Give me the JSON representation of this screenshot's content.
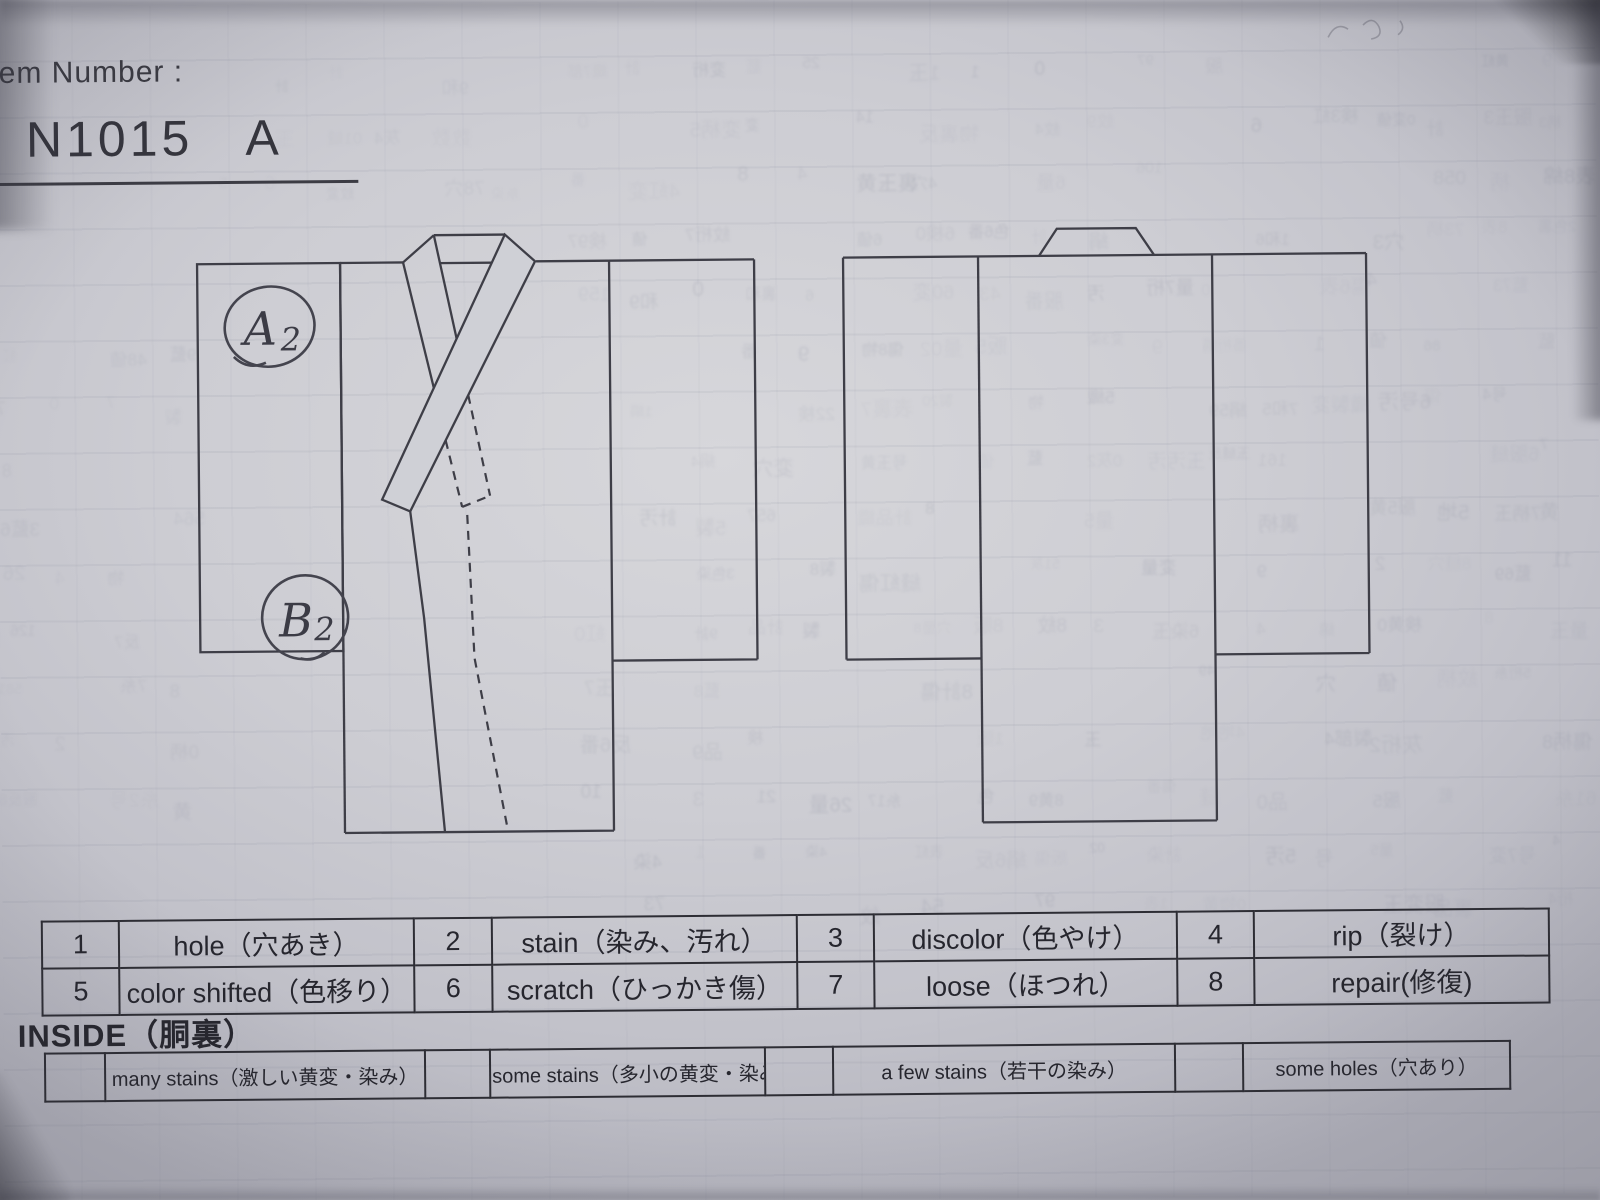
{
  "page": {
    "header_label": "tem Number :",
    "item_number": "N1015",
    "item_suffix": "A"
  },
  "diagram": {
    "front_annotations": [
      {
        "letter": "A",
        "digit": "2"
      },
      {
        "letter": "B",
        "digit": "2"
      }
    ]
  },
  "defect_legend": {
    "rows": [
      [
        {
          "num": "1",
          "label": "hole（穴あき）"
        },
        {
          "num": "2",
          "label": "stain（染み、汚れ）"
        },
        {
          "num": "3",
          "label": "discolor（色やけ）"
        },
        {
          "num": "4",
          "label": "rip（裂け）"
        }
      ],
      [
        {
          "num": "5",
          "label": "color shifted（色移り）"
        },
        {
          "num": "6",
          "label": "scratch（ひっかき傷）"
        },
        {
          "num": "7",
          "label": "loose（ほつれ）"
        },
        {
          "num": "8",
          "label": "repair(修復)"
        }
      ]
    ]
  },
  "inside_section": {
    "title": "INSIDE（胴裏）",
    "options": [
      "many stains（激しい黄変・染み）",
      "some stains（多小の黄変・染み）",
      "a few stains（若干の染み）",
      "some holes（穴あり）"
    ]
  }
}
